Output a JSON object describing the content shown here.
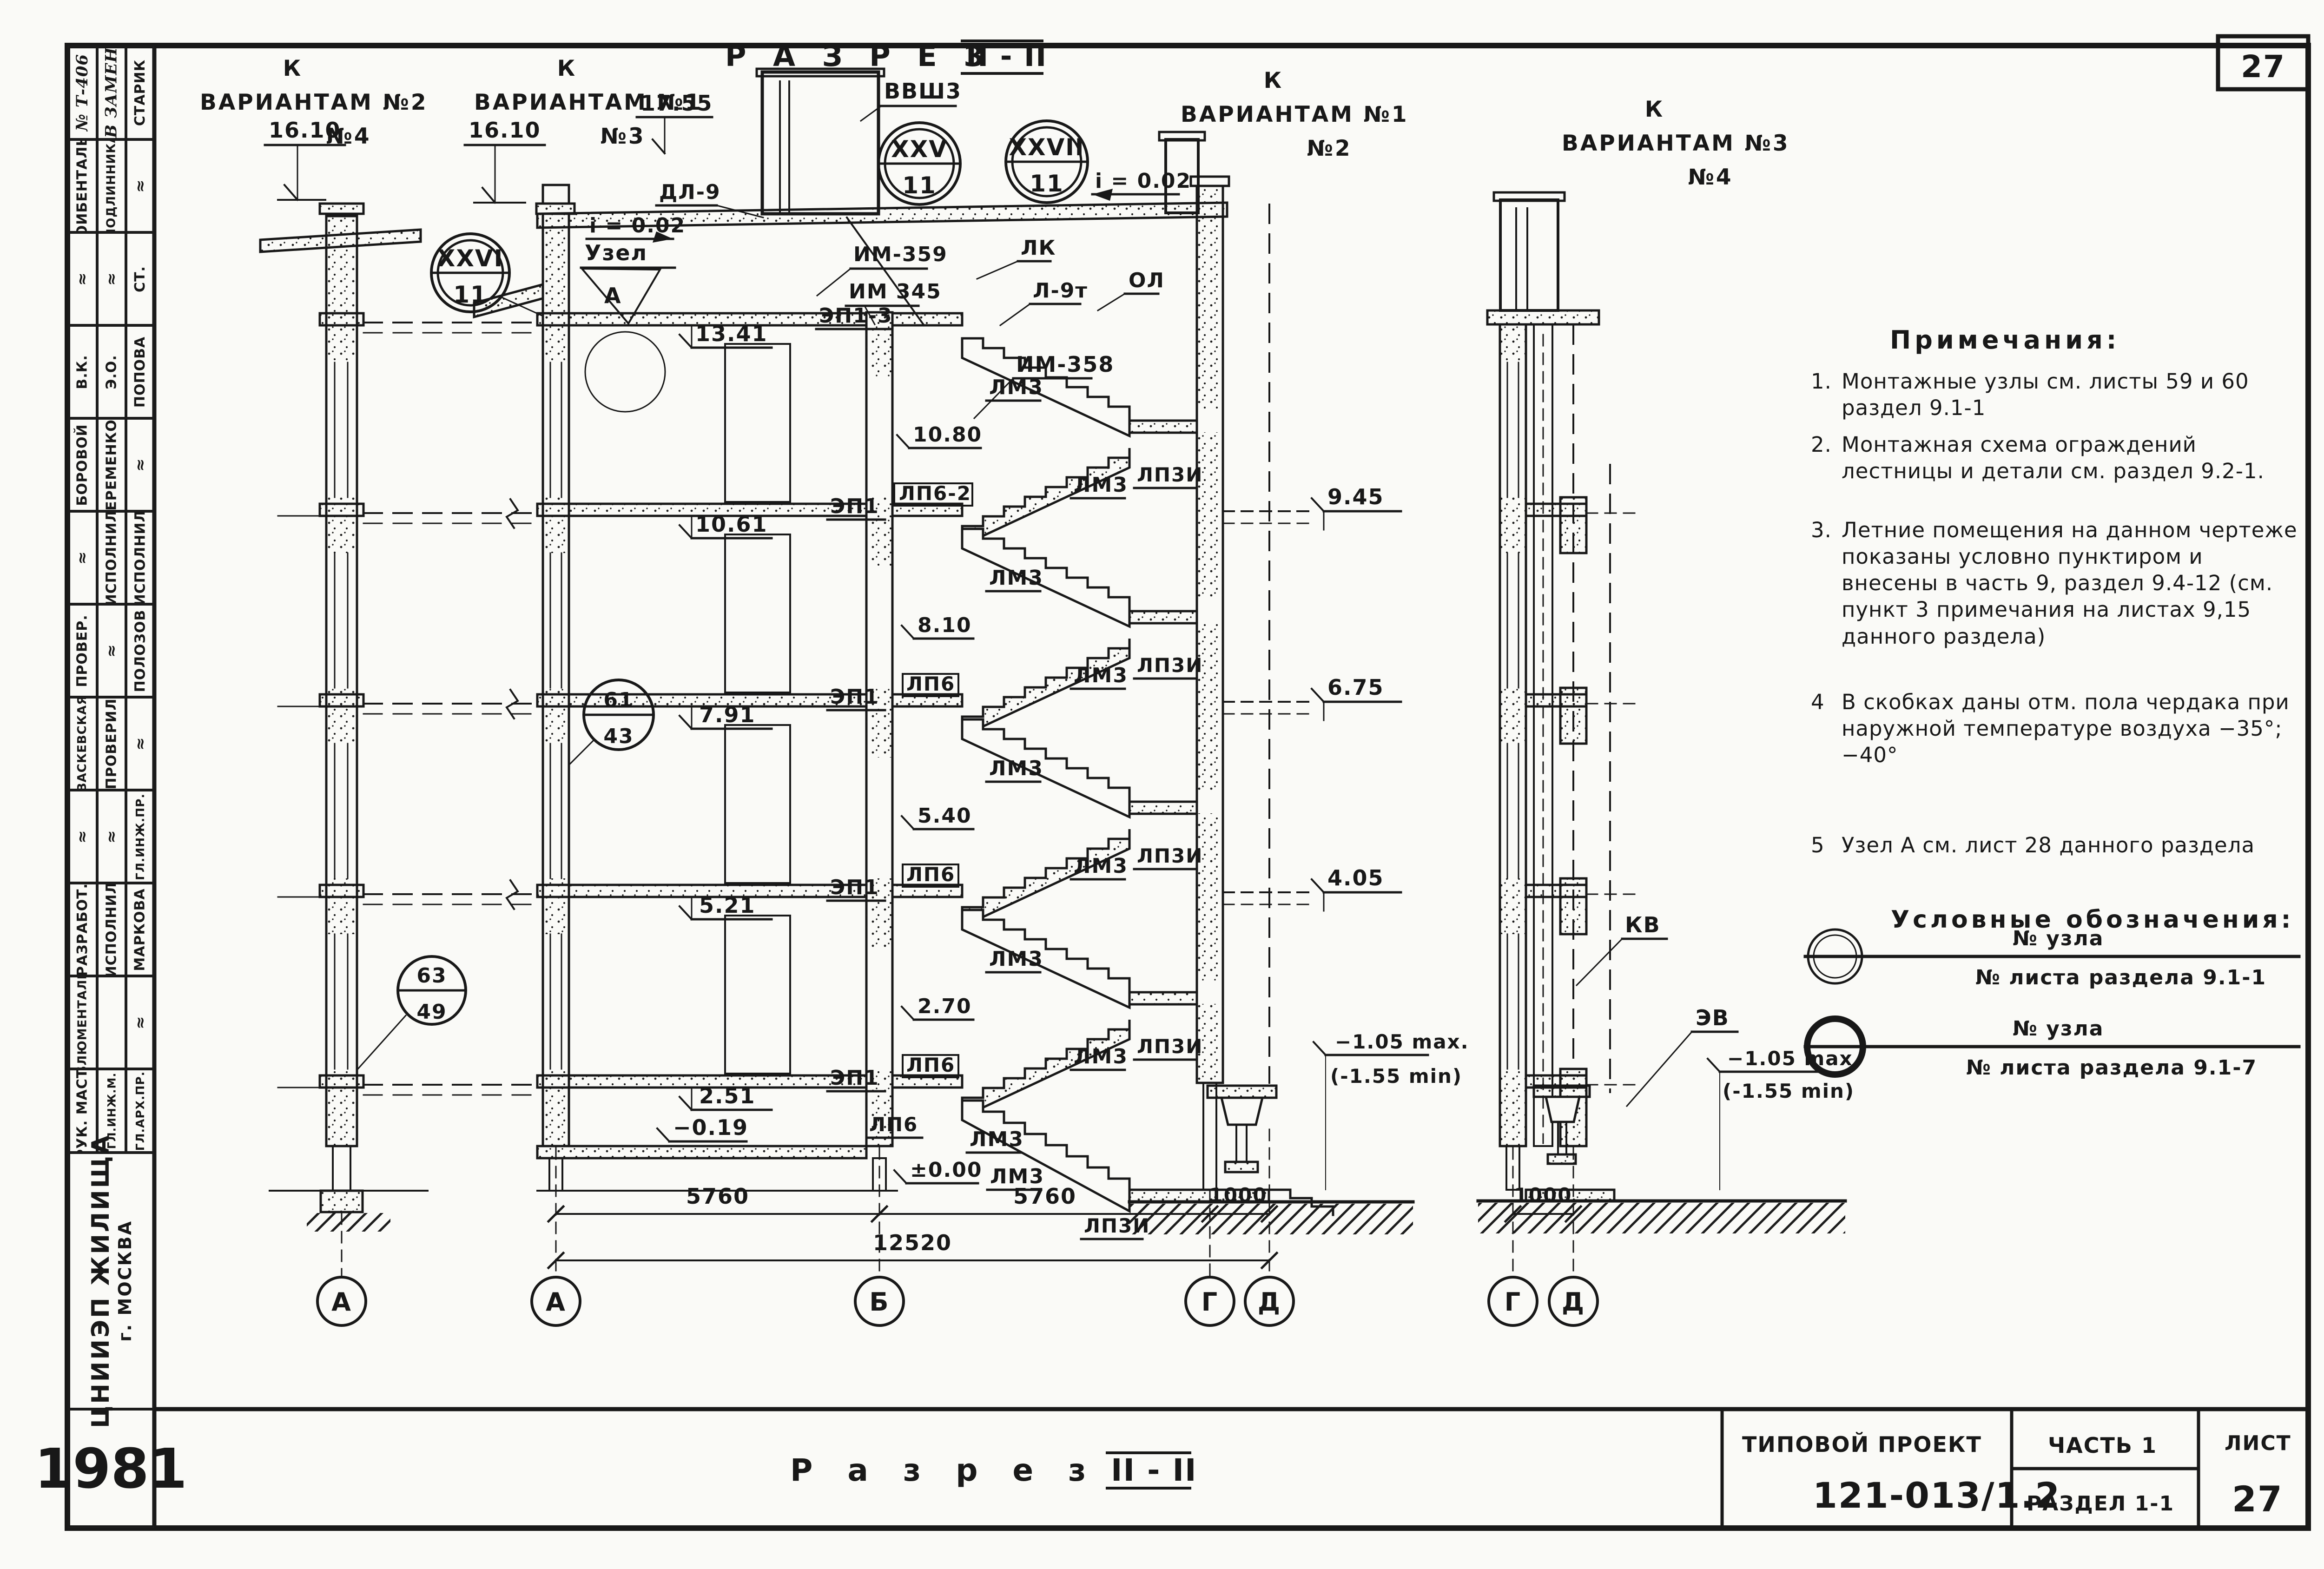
{
  "tb": {
    "project_label": "ТИПОВОЙ ПРОЕКТ",
    "project_number": "121-013/1.2",
    "part": "ЧАСТЬ 1",
    "section": "РАЗДЕЛ 1-1",
    "sheet_label": "ЛИСТ",
    "sheet_number": "27"
  },
  "titles": {
    "top_word": "Р А З Р Е З",
    "top_num": "II - II",
    "bottom_word": "Р а з р е з",
    "bottom_num": "II - II"
  },
  "vh": [
    {
      "k": "К",
      "name": "ВАРИАНТАМ",
      "a": "№2",
      "b": "№4"
    },
    {
      "k": "К",
      "name": "ВАРИАНТАМ",
      "a": "№1",
      "b": "№3"
    },
    {
      "k": "К",
      "name": "ВАРИАНТАМ",
      "a": "№1",
      "b": "№2"
    },
    {
      "k": "К",
      "name": "ВАРИАНТАМ",
      "a": "№3",
      "b": "№4"
    }
  ],
  "notes": {
    "title": "Примечания:",
    "items": [
      {
        "num": "1.",
        "text": "Монтажные узлы см. листы 59 и 60   раздел 9.1-1"
      },
      {
        "num": "2.",
        "text": "Монтажная схема ограждений лестницы и детали см. раздел 9.2-1."
      },
      {
        "num": "3.",
        "text": "Летние помещения на данном чертеже показаны условно пунктиром и внесены в часть 9, раздел 9.4-12 (см. пункт 3 примечания на листах 9,15 данного раздела)"
      },
      {
        "num": "4",
        "text": "В скобках даны отм. пола чердака при наружной температуре воздуха −35°; −40°"
      },
      {
        "num": "5",
        "text": "Узел А   см. лист 28 данного раздела"
      }
    ]
  },
  "legend": {
    "title": "Условные обозначения:",
    "items": [
      {
        "top": "№ узла",
        "bottom": "№ листа раздела 9.1-1"
      },
      {
        "top": "№ узла",
        "bottom": "№ листа раздела 9.1-7"
      }
    ]
  },
  "org": {
    "name": "ЦНИИЭП ЖИЛИЩА",
    "city": "г. МОСКВА",
    "year": "1981"
  },
  "stamp": {
    "cells": [
      {
        "text": "№ Т-406"
      },
      {
        "text": "ОИБЕНТАЛЬ"
      },
      {
        "text": "≈"
      },
      {
        "text": "В.К."
      },
      {
        "text": "БОРОВОЙ"
      },
      {
        "text": "≈"
      },
      {
        "text": "ПРОВЕР."
      },
      {
        "text": "ВАСКЕВСКАЯ"
      },
      {
        "text": "≈"
      },
      {
        "text": "РАЗРАБОТ."
      },
      {
        "text": "БЛЮМЕНТАЛЬ"
      },
      {
        "text": "РУК. МАСТ."
      },
      {
        "text": "В ЗАМЕН"
      },
      {
        "text": "ПОДЛИННИКА"
      },
      {
        "text": "≈"
      },
      {
        "text": "Э.О."
      },
      {
        "text": "ЕРЕМЕНКО"
      },
      {
        "text": "ИСПОЛНИЛ"
      },
      {
        "text": "≈"
      },
      {
        "text": "ПРОВЕРИЛ"
      },
      {
        "text": "≈"
      },
      {
        "text": "ИСПОЛНИЛ"
      },
      {
        "text": ""
      },
      {
        "text": "ГЛ.ИНЖ.М."
      },
      {
        "text": "СТАРИК"
      },
      {
        "text": "≈"
      },
      {
        "text": "СТ."
      },
      {
        "text": "ПОПОВА"
      },
      {
        "text": "≈"
      },
      {
        "text": "ИСПОЛНИЛ"
      },
      {
        "text": "ПОЛОЗОВ"
      },
      {
        "text": "≈"
      },
      {
        "text": "ГЛ.ИНЖ.ПР."
      },
      {
        "text": "МАРКОВА"
      },
      {
        "text": "≈"
      },
      {
        "text": "ГЛ.АРХ.ПР."
      }
    ]
  },
  "d": {
    "e1755": "17.55",
    "e1610": "16.10",
    "e1341": "13.41",
    "e1080": "10.80",
    "e1061": "10.61",
    "e945": "9.45",
    "e810": "8.10",
    "e791": "7.91",
    "e675": "6.75",
    "e540": "5.40",
    "e521": "5.21",
    "e405": "4.05",
    "e270": "2.70",
    "e251": "2.51",
    "e000": "±0.00",
    "em019": "−0.19",
    "em105": "−1.05 max.",
    "em155": "(-1.55 min)",
    "i002": "i = 0.02",
    "vvsh3": "ВВШ3",
    "dl9": "ДЛ-9",
    "lk": "ЛК",
    "l9t": "Л-9т",
    "ol": "ОЛ",
    "im359": "ИМ-359",
    "im345": "ИМ 345",
    "im358": "ИМ-358",
    "ep13": "ЭП1-3",
    "ep1": "ЭП1",
    "lp62": "ЛП6-2",
    "lp6": "ЛП6",
    "lm3": "ЛМ3",
    "lp3i": "ЛП3И",
    "kv": "КВ",
    "ev": "ЭВ",
    "uzel": "Узел",
    "uzelA": "А",
    "n1t": "XXVI",
    "n1b": "11",
    "n2t": "XXV",
    "n2b": "11",
    "n3t": "XXVII",
    "n3b": "11",
    "n61t": "61",
    "n61b": "43",
    "n63t": "63",
    "n63b": "49",
    "d5760": "5760",
    "d12520": "12520",
    "d1000": "1000",
    "axA": "А",
    "axB": "Б",
    "axG": "Г",
    "axD": "Д"
  }
}
